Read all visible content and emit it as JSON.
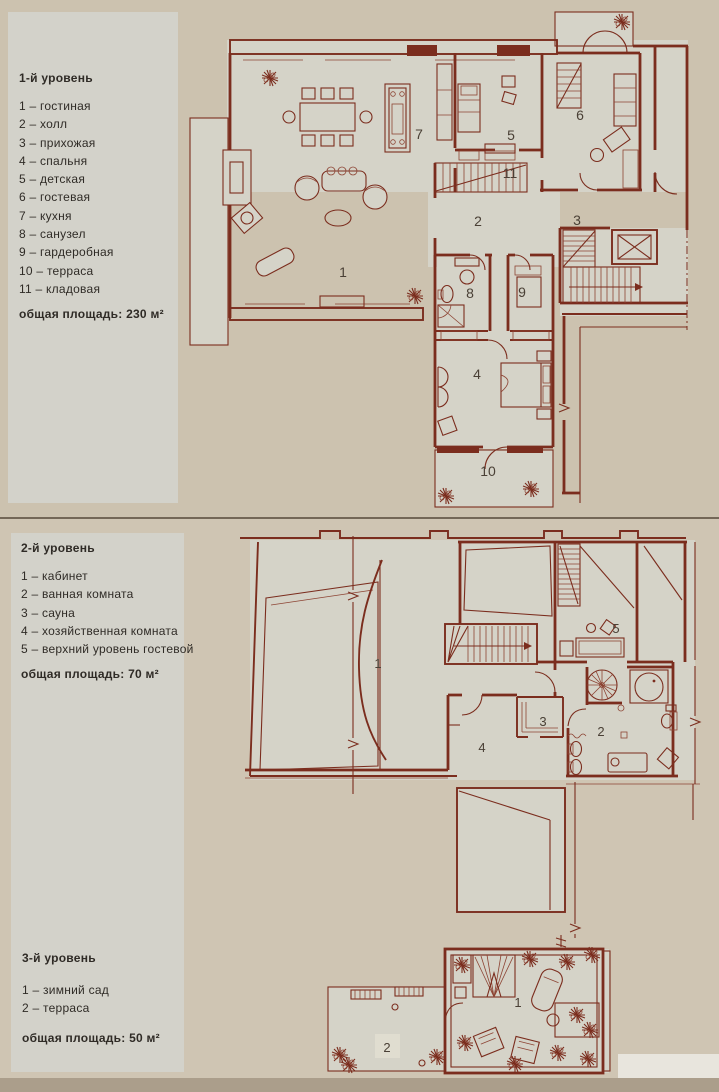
{
  "page": {
    "bg": "#ccc2af",
    "bg_lower": "#cfc5b3",
    "panel_bg": "#d3d2ca",
    "paper": "#d5d3c8",
    "line": "#7b2d1e",
    "line_soft": "#8d4434",
    "number_color": "#4a4036",
    "text_color": "#2f2b26"
  },
  "legend1": {
    "title": "1-й уровень",
    "items": [
      "1 – гостиная",
      "2 – холл",
      "3 – прихожая",
      "4 – спальня",
      "5 – детская",
      "6 – гостевая",
      "7 – кухня",
      "8 – санузел",
      "9 – гардеробная",
      "10 – терраса",
      "11 – кладовая"
    ],
    "total": "общая площадь: 230 м²"
  },
  "legend2": {
    "title": "2-й уровень",
    "items": [
      "1 – кабинет",
      "2 – ванная комната",
      "3 – сауна",
      "4 – хозяйственная комната",
      "5 – верхний уровень гостевой"
    ],
    "total": "общая площадь: 70 м²"
  },
  "legend3": {
    "title": "3-й уровень",
    "items": [
      "1 – зимний сад",
      "2 – терраса"
    ],
    "total": "общая площадь: 50 м²"
  },
  "plans": {
    "level1": {
      "room_labels": [
        {
          "n": "1",
          "x": 158,
          "y": 277
        },
        {
          "n": "7",
          "x": 234,
          "y": 139
        },
        {
          "n": "5",
          "x": 326,
          "y": 140
        },
        {
          "n": "6",
          "x": 395,
          "y": 120
        },
        {
          "n": "11",
          "x": 325,
          "y": 178
        },
        {
          "n": "2",
          "x": 293,
          "y": 226
        },
        {
          "n": "3",
          "x": 392,
          "y": 225
        },
        {
          "n": "8",
          "x": 285,
          "y": 298
        },
        {
          "n": "9",
          "x": 337,
          "y": 297
        },
        {
          "n": "4",
          "x": 292,
          "y": 379
        },
        {
          "n": "10",
          "x": 303,
          "y": 476
        }
      ]
    },
    "level2": {
      "room_labels": [
        {
          "n": "1",
          "x": 148,
          "y": 148
        },
        {
          "n": "5",
          "x": 386,
          "y": 113
        },
        {
          "n": "3",
          "x": 313,
          "y": 206
        },
        {
          "n": "2",
          "x": 371,
          "y": 216
        },
        {
          "n": "4",
          "x": 252,
          "y": 232
        }
      ]
    },
    "level3": {
      "room_labels": [
        {
          "n": "1",
          "x": 203,
          "y": 72
        },
        {
          "n": "2",
          "x": 72,
          "y": 117
        }
      ]
    }
  }
}
